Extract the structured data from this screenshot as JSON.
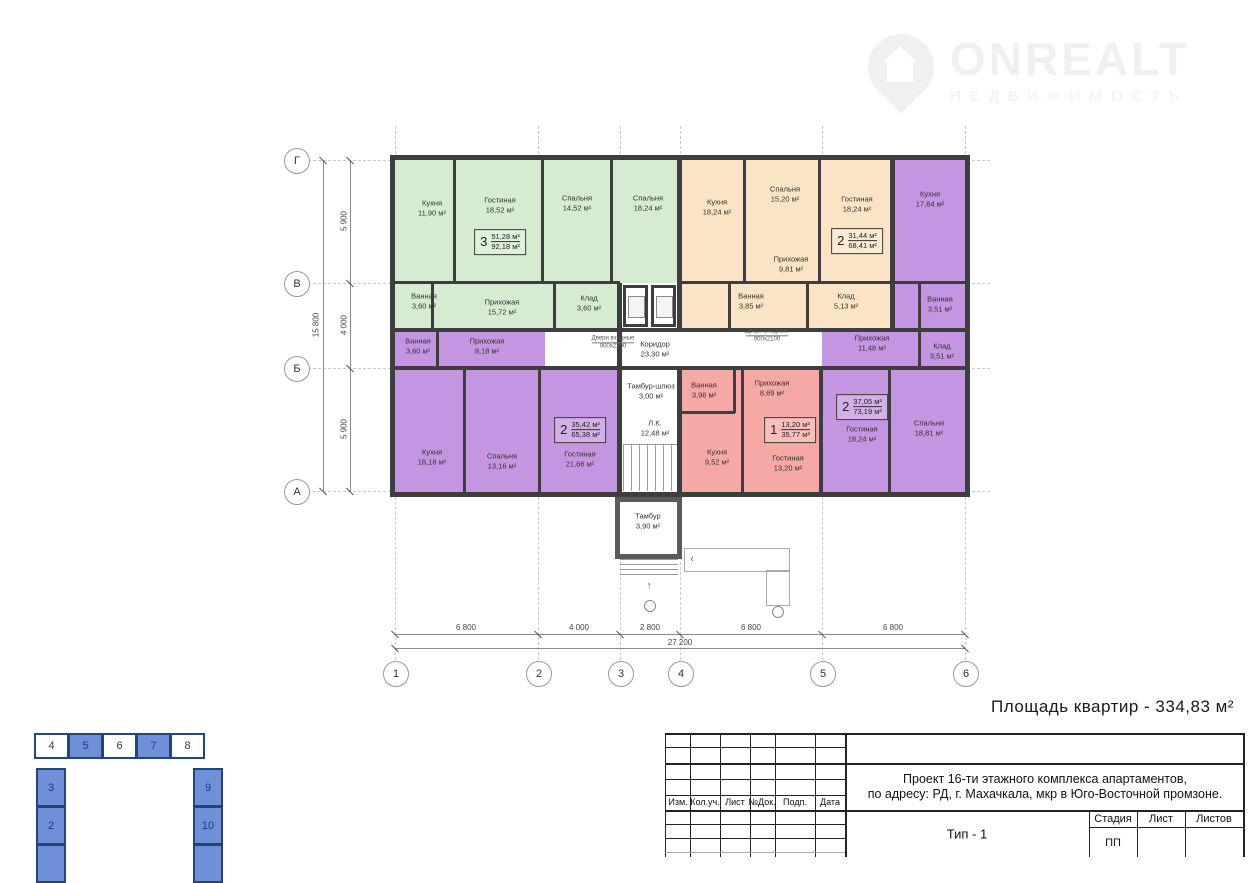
{
  "logo": {
    "name": "ONREALT",
    "subtitle": "НЕДВИЖИМОСТЬ"
  },
  "summary": {
    "text": "Площадь квартир - 334,83 м²"
  },
  "palette": {
    "green": "#d6ecd0",
    "orange": "#fbe4c6",
    "purple": "#c495e0",
    "pink": "#f6a8a5",
    "wall": "#3e3e3e",
    "scheme_blue": "#6d90d8",
    "scheme_border": "#234578"
  },
  "plan": {
    "apartments": [
      {
        "id": "3-room-green",
        "type_number": "3",
        "living_area": "51,28 м²",
        "total_area": "92,18 м²"
      },
      {
        "id": "2-room-orange",
        "type_number": "2",
        "living_area": "31,44 м²",
        "total_area": "68,41 м²"
      },
      {
        "id": "2-room-purple-right",
        "type_number": "2",
        "living_area": "37,05 м²",
        "total_area": "73,19 м²"
      },
      {
        "id": "1-room-pink",
        "type_number": "1",
        "living_area": "13,20 м²",
        "total_area": "35,77 м²"
      },
      {
        "id": "2-room-purple-left",
        "type_number": "2",
        "living_area": "35,42 м²",
        "total_area": "65,38 м²"
      }
    ],
    "rooms": [
      {
        "name": "Кухня",
        "area": "11,90 м²"
      },
      {
        "name": "Гостиная",
        "area": "18,52 м²"
      },
      {
        "name": "Спальня",
        "area": "14,52 м²"
      },
      {
        "name": "Спальня",
        "area": "18,24 м²"
      },
      {
        "name": "Ванная",
        "area": "3,60 м²"
      },
      {
        "name": "Прихожая",
        "area": "15,72 м²"
      },
      {
        "name": "Клад",
        "area": "3,60 м²"
      },
      {
        "name": "Кухня",
        "area": "18,24 м²"
      },
      {
        "name": "Спальня",
        "area": "15,20 м²"
      },
      {
        "name": "Гостиная",
        "area": "18,24 м²"
      },
      {
        "name": "Прихожая",
        "area": "9,81 м²"
      },
      {
        "name": "Ванная",
        "area": "3,85 м²"
      },
      {
        "name": "Клад",
        "area": "5,13 м²"
      },
      {
        "name": "Кухня",
        "area": "17,64 м²"
      },
      {
        "name": "Ванная",
        "area": "3,51 м²"
      },
      {
        "name": "Клад",
        "area": "3,51 м²"
      },
      {
        "name": "Прихожая",
        "area": "11,48 м²"
      },
      {
        "name": "Гостиная",
        "area": "18,24 м²"
      },
      {
        "name": "Спальня",
        "area": "18,81 м²"
      },
      {
        "name": "Ванная",
        "area": "3,96 м²"
      },
      {
        "name": "Прихожая",
        "area": "8,69 м²"
      },
      {
        "name": "Кухня",
        "area": "9,52 м²"
      },
      {
        "name": "Гостиная",
        "area": "13,20 м²"
      },
      {
        "name": "Ванная",
        "area": "3,60 м²"
      },
      {
        "name": "Прихожая",
        "area": "8,18 м²"
      },
      {
        "name": "Кухня",
        "area": "18,18 м²"
      },
      {
        "name": "Спальня",
        "area": "13,16 м²"
      },
      {
        "name": "Гостиная",
        "area": "21,66 м²"
      },
      {
        "name": "Коридор",
        "area": "23,30 м²"
      },
      {
        "name": "Тамбур-шлюз",
        "area": "3,00 м²"
      },
      {
        "name": "Л.К.",
        "area": "12,48 м²"
      },
      {
        "name": "Тамбур",
        "area": "3,90 м²"
      }
    ],
    "annotations": [
      {
        "label": "Двери входные",
        "size": "900х2100"
      },
      {
        "label": "Двери входные",
        "size": "900х2100"
      }
    ],
    "axes_h": [
      "1",
      "2",
      "3",
      "4",
      "5",
      "6"
    ],
    "axes_v": [
      "Г",
      "В",
      "Б",
      "А"
    ],
    "dim_bottom": {
      "segments": [
        "6 800",
        "4 000",
        "2 800",
        "6 800",
        "6 800"
      ],
      "total": "27 200"
    },
    "dim_left": {
      "segments": [
        "5 900",
        "4 000",
        "5 900"
      ],
      "total": "15 800"
    }
  },
  "title_block": {
    "project_line1": "Проект 16-ти этажного комплекса апартаментов,",
    "project_line2": "по адресу: РД, г. Махачкала, мкр в Юго-Восточной промзоне.",
    "type_label": "Тип - 1",
    "columns": [
      "Изм.",
      "Кол.уч.",
      "Лист",
      "№Док.",
      "Подп.",
      "Дата"
    ],
    "stage_headers": [
      "Стадия",
      "Лист",
      "Листов"
    ],
    "stage_value": "ПП"
  },
  "unit_scheme": {
    "top_cells": [
      "4",
      "5",
      "6",
      "7",
      "8"
    ],
    "left_cells": [
      "3",
      "2"
    ],
    "right_cells": [
      "9",
      "10"
    ]
  }
}
